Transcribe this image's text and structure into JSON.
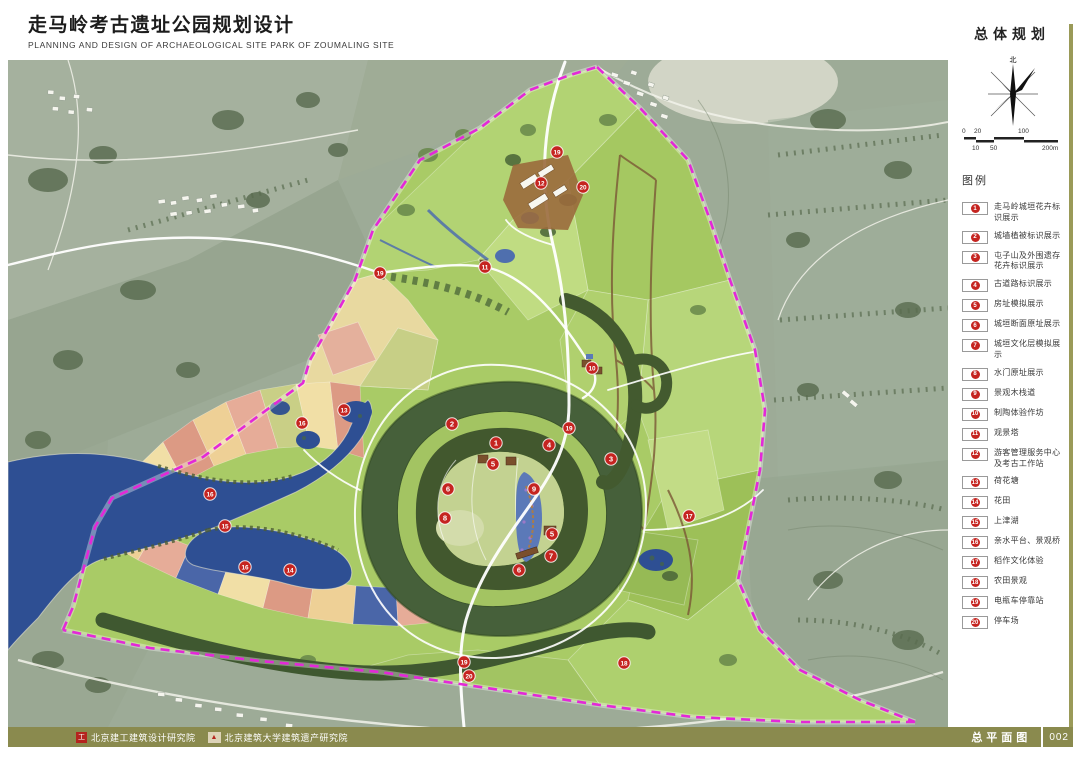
{
  "header": {
    "title_cn": "走马岭考古遗址公园规划设计",
    "title_en": "PLANNING AND DESIGN OF ARCHAEOLOGICAL  SITE PARK OF ZOUMALING SITE"
  },
  "sheet": {
    "plan_type": "总体规划",
    "sheet_name": "总平面图",
    "page_number": "002"
  },
  "footer": {
    "institute_1": "北京建工建筑设计研究院",
    "institute_2": "北京建筑大学建筑遗产研究院"
  },
  "compass": {
    "north_label": "北"
  },
  "scalebar": {
    "top_labels": [
      "0",
      "20",
      "100"
    ],
    "bottom_labels": [
      "10",
      "50",
      "200m"
    ]
  },
  "legend": {
    "title": "图例",
    "items": [
      {
        "num": "1",
        "label": "走马岭城垣花卉标识展示"
      },
      {
        "num": "2",
        "label": "城墙植被标识展示"
      },
      {
        "num": "3",
        "label": "屯子山及外围遗存花卉标识展示"
      },
      {
        "num": "4",
        "label": "古道路标识展示"
      },
      {
        "num": "5",
        "label": "房址模拟展示"
      },
      {
        "num": "6",
        "label": "城垣断面原址展示"
      },
      {
        "num": "7",
        "label": "城垣文化层模拟展示"
      },
      {
        "num": "8",
        "label": "水门原址展示"
      },
      {
        "num": "9",
        "label": "景观木栈道"
      },
      {
        "num": "10",
        "label": "制陶体验作坊"
      },
      {
        "num": "11",
        "label": "观景塔"
      },
      {
        "num": "12",
        "label": "游客管理服务中心及考古工作站"
      },
      {
        "num": "13",
        "label": "荷花塘"
      },
      {
        "num": "14",
        "label": "花田"
      },
      {
        "num": "15",
        "label": "上津湖"
      },
      {
        "num": "16",
        "label": "亲水平台、景观桥"
      },
      {
        "num": "17",
        "label": "稻作文化体验"
      },
      {
        "num": "18",
        "label": "农田景观"
      },
      {
        "num": "19",
        "label": "电瓶车停靠站"
      },
      {
        "num": "20",
        "label": "停车场"
      }
    ]
  },
  "map": {
    "colors": {
      "boundary_magenta": "#e428d8",
      "marker_red": "#c52420",
      "lake_blue": "#2e4f93",
      "park_green": "#a9cb66",
      "footer_olive": "#8a8a4e"
    },
    "markers": [
      {
        "label": "19",
        "x": 549,
        "y": 92
      },
      {
        "label": "12",
        "x": 533,
        "y": 123
      },
      {
        "label": "20",
        "x": 575,
        "y": 127
      },
      {
        "label": "19",
        "x": 372,
        "y": 213
      },
      {
        "label": "11",
        "x": 477,
        "y": 207
      },
      {
        "label": "10",
        "x": 584,
        "y": 308
      },
      {
        "label": "13",
        "x": 336,
        "y": 350
      },
      {
        "label": "16",
        "x": 294,
        "y": 363
      },
      {
        "label": "2",
        "x": 444,
        "y": 364
      },
      {
        "label": "19",
        "x": 561,
        "y": 368
      },
      {
        "label": "1",
        "x": 488,
        "y": 383
      },
      {
        "label": "4",
        "x": 541,
        "y": 385
      },
      {
        "label": "3",
        "x": 603,
        "y": 399
      },
      {
        "label": "5",
        "x": 485,
        "y": 404
      },
      {
        "label": "6",
        "x": 440,
        "y": 429
      },
      {
        "label": "9",
        "x": 526,
        "y": 429
      },
      {
        "label": "16",
        "x": 202,
        "y": 434
      },
      {
        "label": "8",
        "x": 437,
        "y": 458
      },
      {
        "label": "17",
        "x": 681,
        "y": 456
      },
      {
        "label": "15",
        "x": 217,
        "y": 466
      },
      {
        "label": "5",
        "x": 544,
        "y": 474
      },
      {
        "label": "7",
        "x": 543,
        "y": 496
      },
      {
        "label": "16",
        "x": 237,
        "y": 507
      },
      {
        "label": "14",
        "x": 282,
        "y": 510
      },
      {
        "label": "6",
        "x": 511,
        "y": 510
      },
      {
        "label": "19",
        "x": 456,
        "y": 602
      },
      {
        "label": "18",
        "x": 616,
        "y": 603
      },
      {
        "label": "20",
        "x": 461,
        "y": 616
      }
    ]
  }
}
